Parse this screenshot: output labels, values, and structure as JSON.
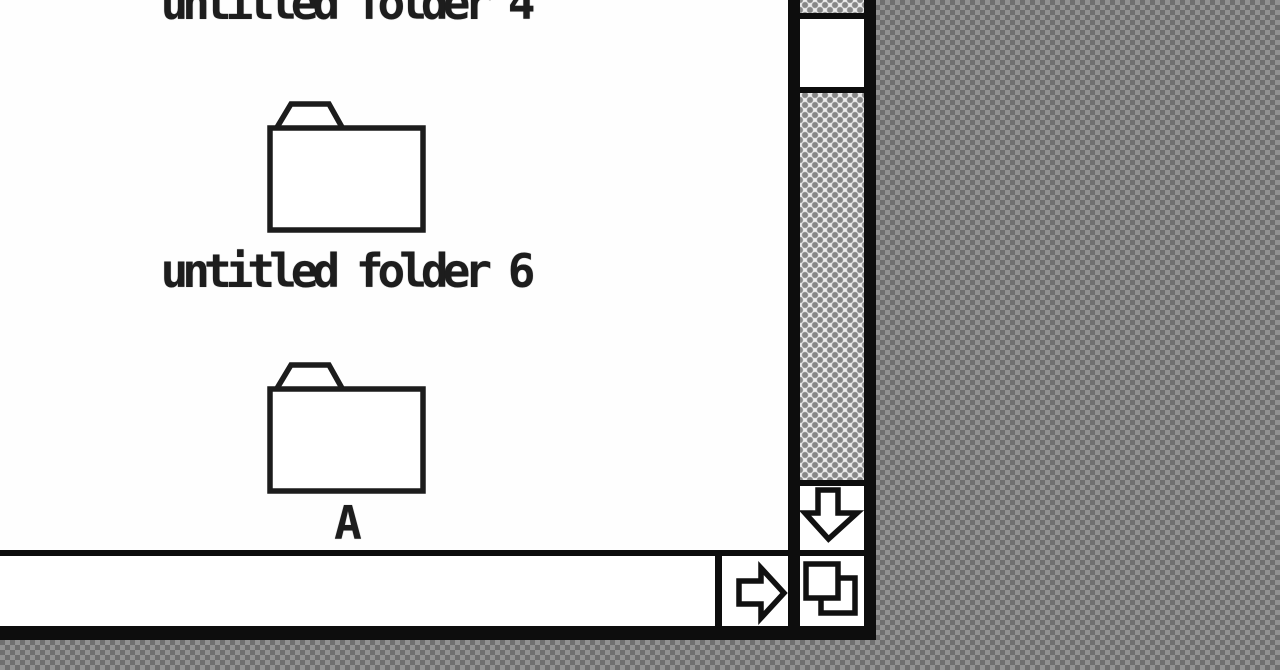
{
  "desktop": {
    "pattern_light": "#919191",
    "pattern_dark": "#6f6f6f"
  },
  "window": {
    "items": [
      {
        "type": "folder",
        "icon": "folder-icon",
        "label": "untitled folder 4",
        "clipped_at_top": true
      },
      {
        "type": "folder",
        "icon": "folder-icon",
        "label": "untitled folder 6"
      },
      {
        "type": "folder",
        "icon": "folder-icon",
        "label": "A"
      }
    ],
    "scrollbars": {
      "vertical": {
        "thumb_visible": true,
        "down_arrow_icon": "arrow-down-icon"
      },
      "horizontal": {
        "thumb_visible": false,
        "right_arrow_icon": "arrow-right-icon"
      },
      "grow_icon": "grow-box-icon"
    },
    "colors": {
      "frame": "#0d0d0d",
      "content_bg": "#ffffff",
      "track_bg": "#efefef",
      "track_dot": "#878787",
      "text": "#1d1d1d"
    }
  }
}
